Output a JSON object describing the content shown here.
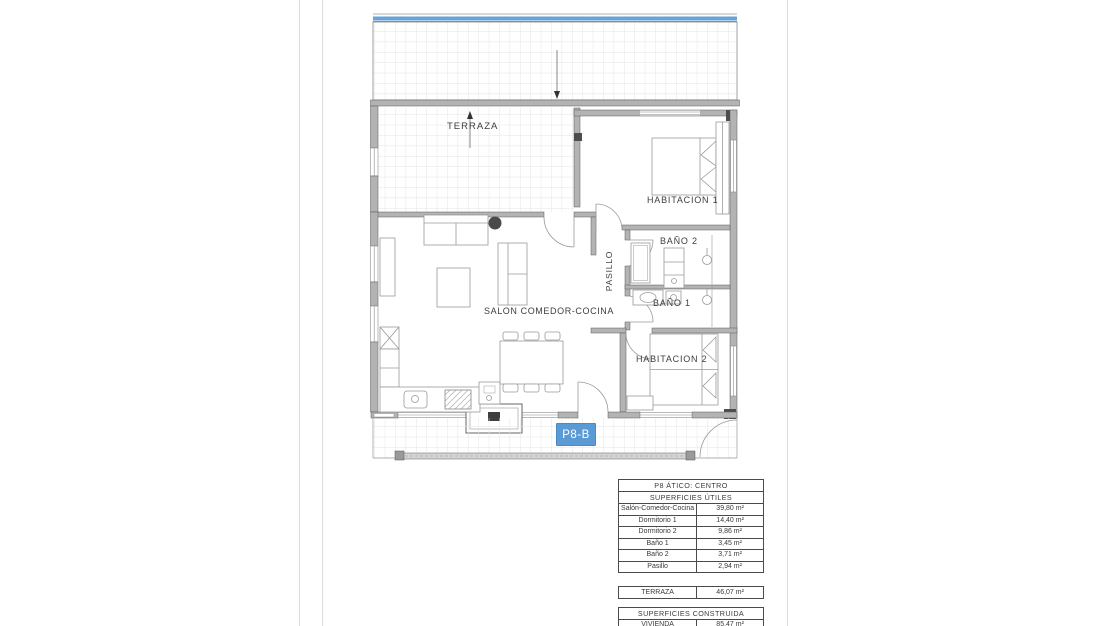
{
  "plan": {
    "labels": {
      "terraza": "TERRAZA",
      "habitacion1": "HABITACION 1",
      "bano2": "BAÑO 2",
      "bano1": "BAÑO 1",
      "pasillo": "PASILLO",
      "salon": "SALON COMEDOR-COCINA",
      "habitacion2": "HABITACION 2"
    },
    "badge": {
      "label": "P8-B"
    }
  },
  "tables": {
    "useful": {
      "title": "P8 ÁTICO: CENTRO",
      "subtitle": "SUPERFICIES ÚTILES",
      "rows": [
        {
          "label": "Salón-Comedor-Cocina",
          "value": "39,80 m²"
        },
        {
          "label": "Dormitorio 1",
          "value": "14,40 m²"
        },
        {
          "label": "Dormitorio 2",
          "value": "9,86 m²"
        },
        {
          "label": "Baño 1",
          "value": "3,45 m²"
        },
        {
          "label": "Baño 2",
          "value": "3,71 m²"
        },
        {
          "label": "Pasillo",
          "value": "2,94 m²"
        }
      ]
    },
    "terrace": {
      "label": "TERRAZA",
      "value": "46,07 m²"
    },
    "built": {
      "title": "SUPERFICIES CONSTRUIDA",
      "rows": [
        {
          "label": "VIVIENDA",
          "value": "85,47 m²"
        }
      ]
    }
  },
  "colors": {
    "accent_blue": "#5b9bd5",
    "wall_gray": "#b3b3b3",
    "tile_line": "#e4e4e4"
  }
}
